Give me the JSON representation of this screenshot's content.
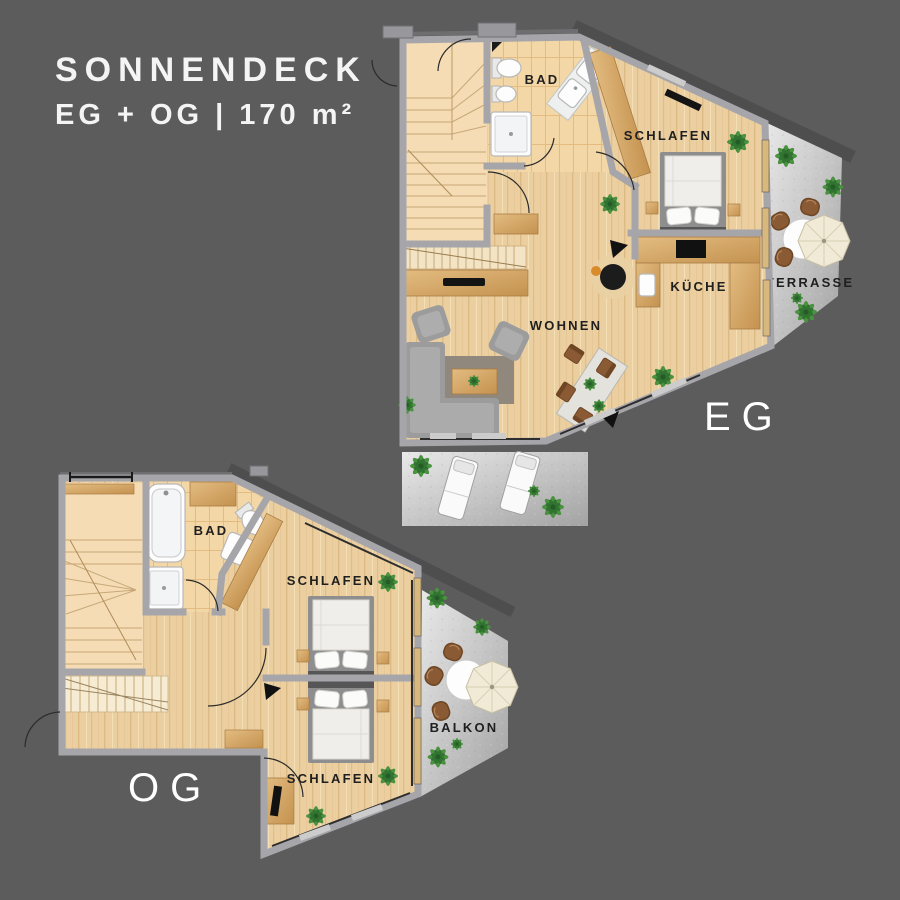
{
  "title": {
    "line1": "SONNENDECK",
    "line2": "EG + OG | 170 m²"
  },
  "floors": {
    "eg": {
      "label": "EG",
      "rooms": {
        "bad": "BAD",
        "schlafen": "SCHLAFEN",
        "kueche": "KÜCHE",
        "wohnen": "WOHNEN",
        "terrasse": "TERRASSE"
      }
    },
    "og": {
      "label": "OG",
      "rooms": {
        "bad": "BAD",
        "schlafen_top": "SCHLAFEN",
        "schlafen_bottom": "SCHLAFEN",
        "balkon": "BALKON"
      }
    }
  },
  "colors": {
    "background": "#5c5c5c",
    "wood_floor": "#eccfa0",
    "stair_floor": "#f5dcb4",
    "tile_floor": "#f3d7a6",
    "wall": "#a6a6aa",
    "terrace": "#c7c7c7",
    "wood_furniture": "#d4a76a",
    "label_text": "#1f1f1f",
    "floor_label_text": "#ffffff",
    "plant": "#3f8f3c",
    "chair_brown": "#8a5a35"
  }
}
